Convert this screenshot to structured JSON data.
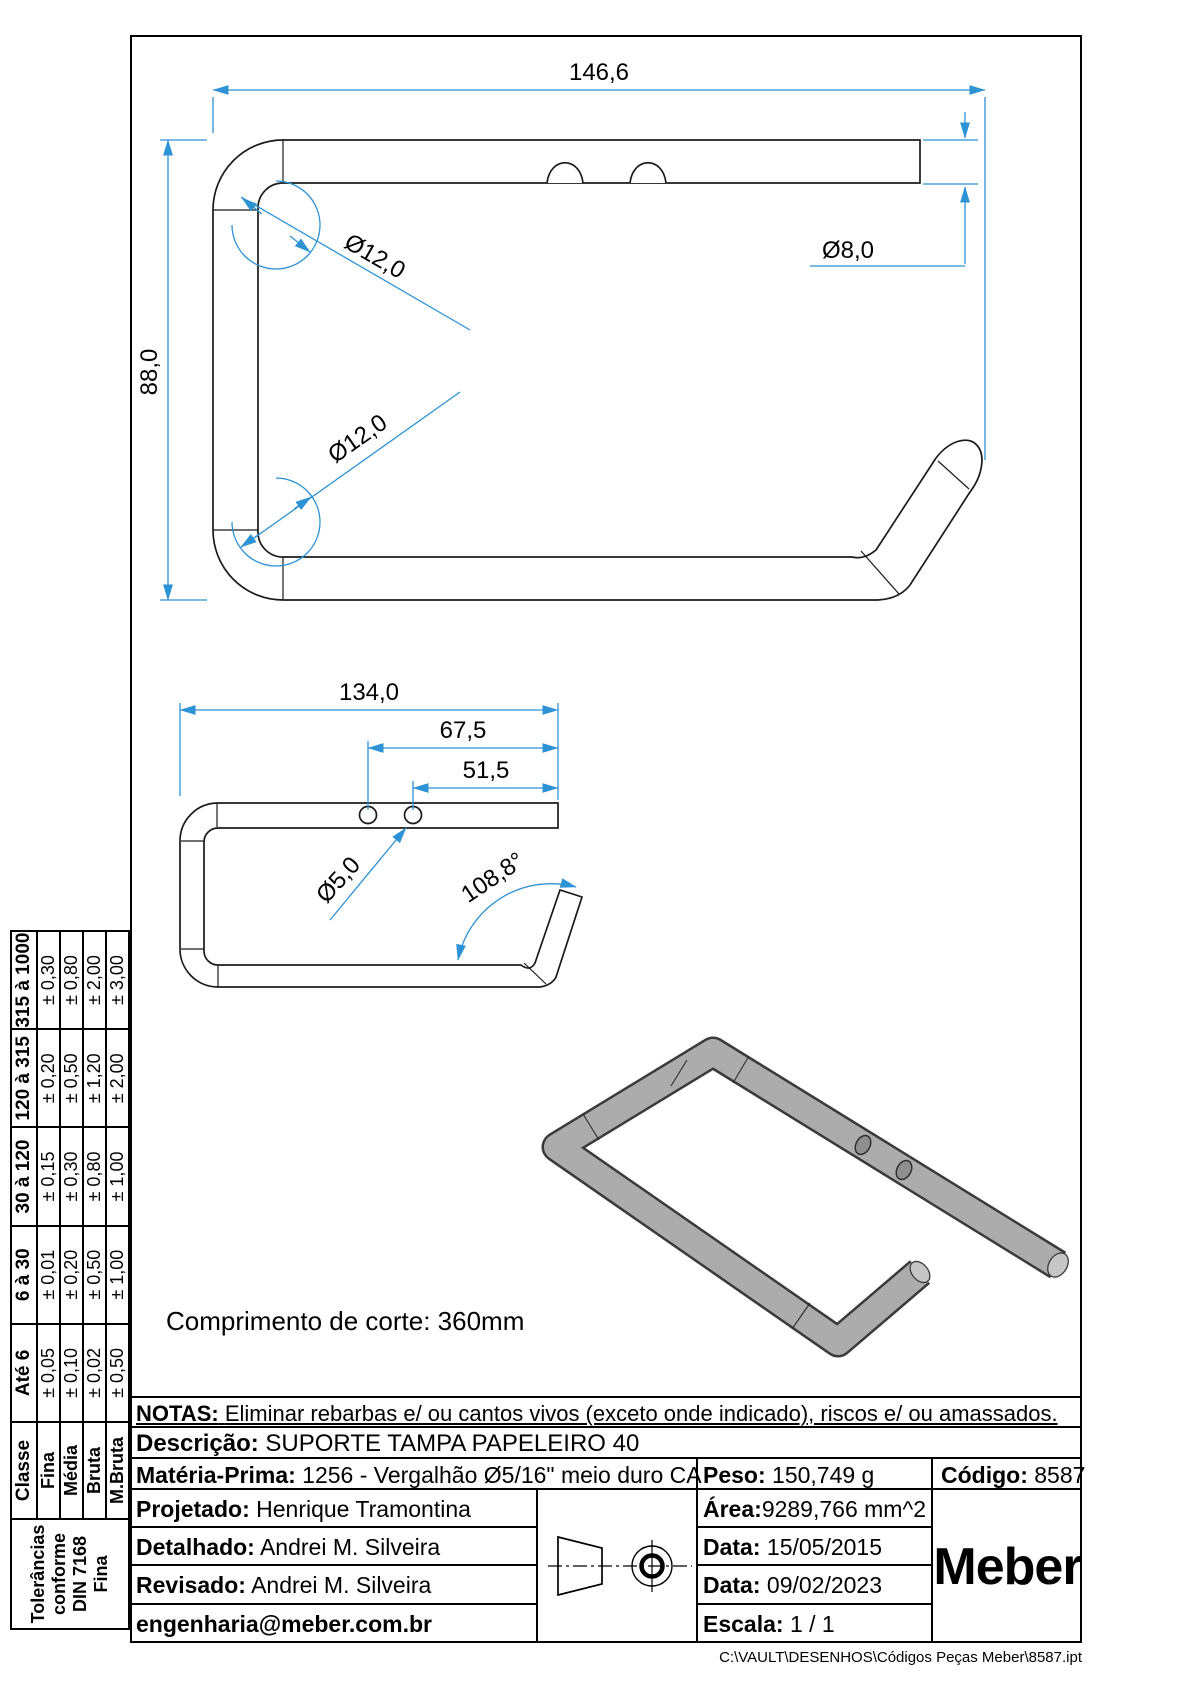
{
  "colors": {
    "dimension": "#2e93d4",
    "part_line": "#1b1b1b"
  },
  "drawing": {
    "cut_length_note": "Comprimento de corte: 360mm",
    "top_view": {
      "length": "146,6",
      "height": "88,0",
      "bend_top": "Ø12,0",
      "bend_bottom": "Ø12,0",
      "rod_diameter": "Ø8,0"
    },
    "front_view": {
      "length": "134,0",
      "hole1_offset": "67,5",
      "hole2_offset": "51,5",
      "hole_diameter": "Ø5,0",
      "bend_angle": "108,8°"
    }
  },
  "tolerance_table": {
    "side_label_lines": [
      "Tolerâncias",
      "conforme",
      "DIN 7168",
      "Fina"
    ],
    "class_header": "Classe",
    "range_headers": [
      "Até 6",
      "6 à 30",
      "30 à 120",
      "120 à 315",
      "315 à 1000"
    ],
    "rows": [
      {
        "classe": "Fina",
        "values": [
          "± 0,05",
          "± 0,01",
          "± 0,15",
          "± 0,20",
          "± 0,30"
        ]
      },
      {
        "classe": "Média",
        "values": [
          "± 0,10",
          "± 0,20",
          "± 0,30",
          "± 0,50",
          "± 0,80"
        ]
      },
      {
        "classe": "Bruta",
        "values": [
          "± 0,02",
          "± 0,50",
          "± 0,80",
          "± 1,20",
          "± 2,00"
        ]
      },
      {
        "classe": "M.Bruta",
        "values": [
          "± 0,50",
          "± 1,00",
          "± 1,00",
          "± 2,00",
          "± 3,00"
        ]
      }
    ]
  },
  "title_block": {
    "notas_label": "NOTAS:",
    "notas_text": "Eliminar rebarbas e/ ou cantos vivos (exceto onde indicado), riscos e/ ou amassados.",
    "descricao_label": "Descrição:",
    "descricao": "SUPORTE TAMPA PAPELEIRO 40",
    "materia_prima_label": "Matéria-Prima:",
    "materia_prima": "1256 - Vergalhão Ø5/16\" meio duro CA",
    "peso_label": "Peso:",
    "peso": "150,749 g",
    "codigo_label": "Código:",
    "codigo": "8587",
    "projetado_label": "Projetado:",
    "projetado": "Henrique Tramontina",
    "detalhado_label": "Detalhado:",
    "detalhado": "Andrei M. Silveira",
    "revisado_label": "Revisado:",
    "revisado": "Andrei M. Silveira",
    "email": "engenharia@meber.com.br",
    "area_label": "Área:",
    "area": "9289,766 mm^2",
    "data1_label": "Data:",
    "data1": "15/05/2015",
    "data2_label": "Data:",
    "data2": "09/02/2023",
    "escala_label": "Escala:",
    "escala": "1 / 1",
    "logo": "Meber"
  },
  "footer": {
    "file_path": "C:\\VAULT\\DESENHOS\\Códigos Peças Meber\\8587.ipt"
  }
}
